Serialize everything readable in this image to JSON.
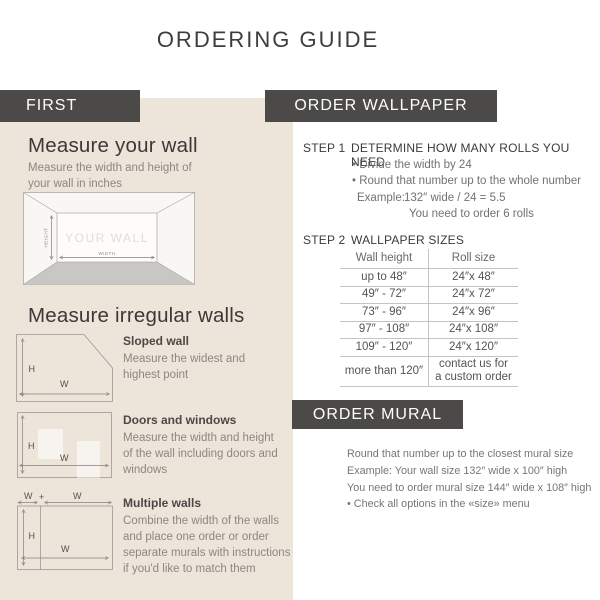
{
  "page": {
    "title": "ORDERING GUIDE"
  },
  "left": {
    "header": "FIRST",
    "measure_wall": {
      "heading": "Measure your wall",
      "description": "Measure the width and height of your wall in inches",
      "diagram": {
        "wall_label": "YOUR WALL",
        "height_label": "HEIGHT",
        "width_label": "WIDTH"
      }
    },
    "irregular": {
      "heading": "Measure irregular walls",
      "items": [
        {
          "title": "Sloped wall",
          "description": "Measure the widest and highest point"
        },
        {
          "title": "Doors and windows",
          "description": "Measure the width and height of the wall including doors and windows"
        },
        {
          "title": "Multiple walls",
          "description": "Combine the width of the walls and place one order or order separate murals with instructions if you'd like to match them"
        }
      ],
      "labels": {
        "h": "H",
        "w": "W",
        "plus": "+"
      }
    }
  },
  "wallpaper": {
    "header": "ORDER WALLPAPER",
    "step1": {
      "label": "STEP 1",
      "title": "DETERMINE HOW MANY ROLLS YOU NEED",
      "bullets": [
        "• Divide the width by 24",
        "• Round that number up to the whole number"
      ],
      "example_label": "Example:",
      "example_value": "132″ wide / 24 = 5.5",
      "example_result": "You need to order 6 rolls"
    },
    "step2": {
      "label": "STEP 2",
      "title": "WALLPAPER SIZES",
      "table": {
        "columns": [
          "Wall height",
          "Roll size"
        ],
        "rows": [
          [
            "up to 48″",
            "24″x 48″"
          ],
          [
            "49″ - 72″",
            "24″x 72″"
          ],
          [
            "73″ - 96″",
            "24″x 96″"
          ],
          [
            "97″ - 108″",
            "24″x 108″"
          ],
          [
            "109″ - 120″",
            "24″x 120″"
          ],
          [
            "more than 120″",
            "contact us for a custom order"
          ]
        ]
      }
    }
  },
  "mural": {
    "header": "ORDER MURAL",
    "lines": [
      "Round that number up to the closest mural size",
      "Example: Your wall size 132″ wide x 100″ high",
      "You need to order mural size 144″ wide x 108″ high",
      "• Check all options in the «size» menu"
    ]
  },
  "colors": {
    "bar_background": "#4b4a48",
    "panel_background": "#ede4da",
    "heading_text": "#3b3a38",
    "body_text_gray": "#8c8881",
    "table_line": "#c6c4c0"
  }
}
